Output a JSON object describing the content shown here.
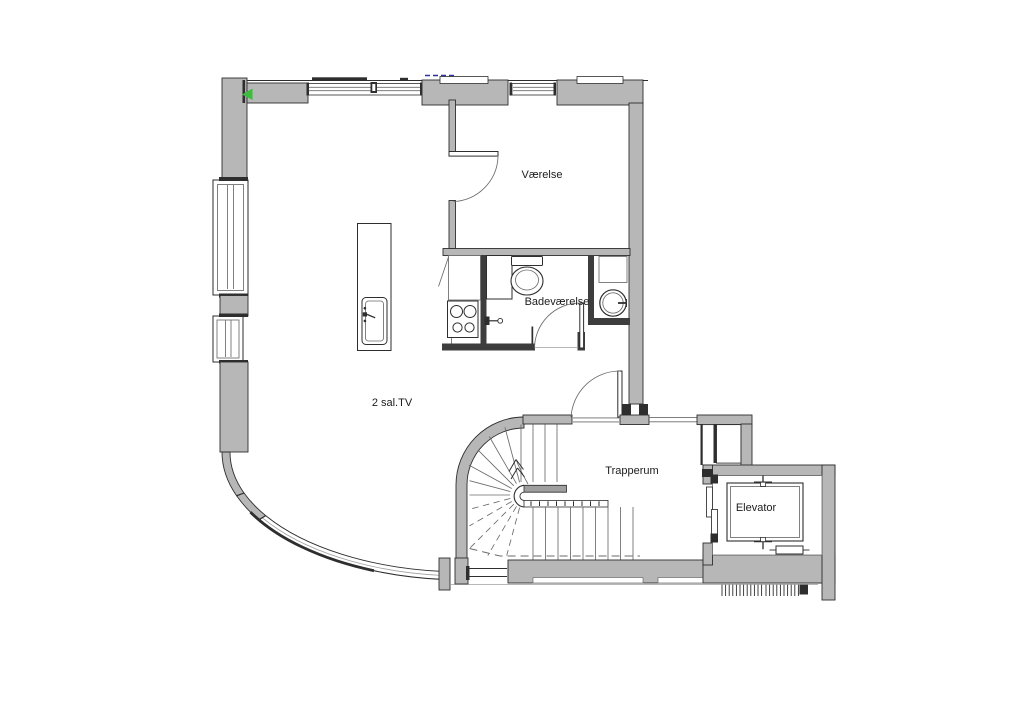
{
  "plan": {
    "labels": {
      "room1": "Værelse",
      "bathroom": "Badeværelse",
      "living": "2 sal.TV",
      "stairwell": "Trapperum",
      "elevator": "Elevator"
    },
    "fixtures": [
      "toilet",
      "washbasin",
      "shower-valve",
      "kitchen-island-sink",
      "stove",
      "spiral-staircase",
      "elevator-cab",
      "counterweight"
    ],
    "colors": {
      "background": "#ffffff",
      "wall_fill": "#b7b7b7",
      "wall_dark": "#3d3d3d",
      "line": "#2e2e2e",
      "thin_line": "#6b6b6b",
      "light_line": "#9f9f9f",
      "marker_green": "#3ebc3e",
      "marker_blue": "#2f2fa8",
      "text": "#1c1c1c"
    }
  }
}
